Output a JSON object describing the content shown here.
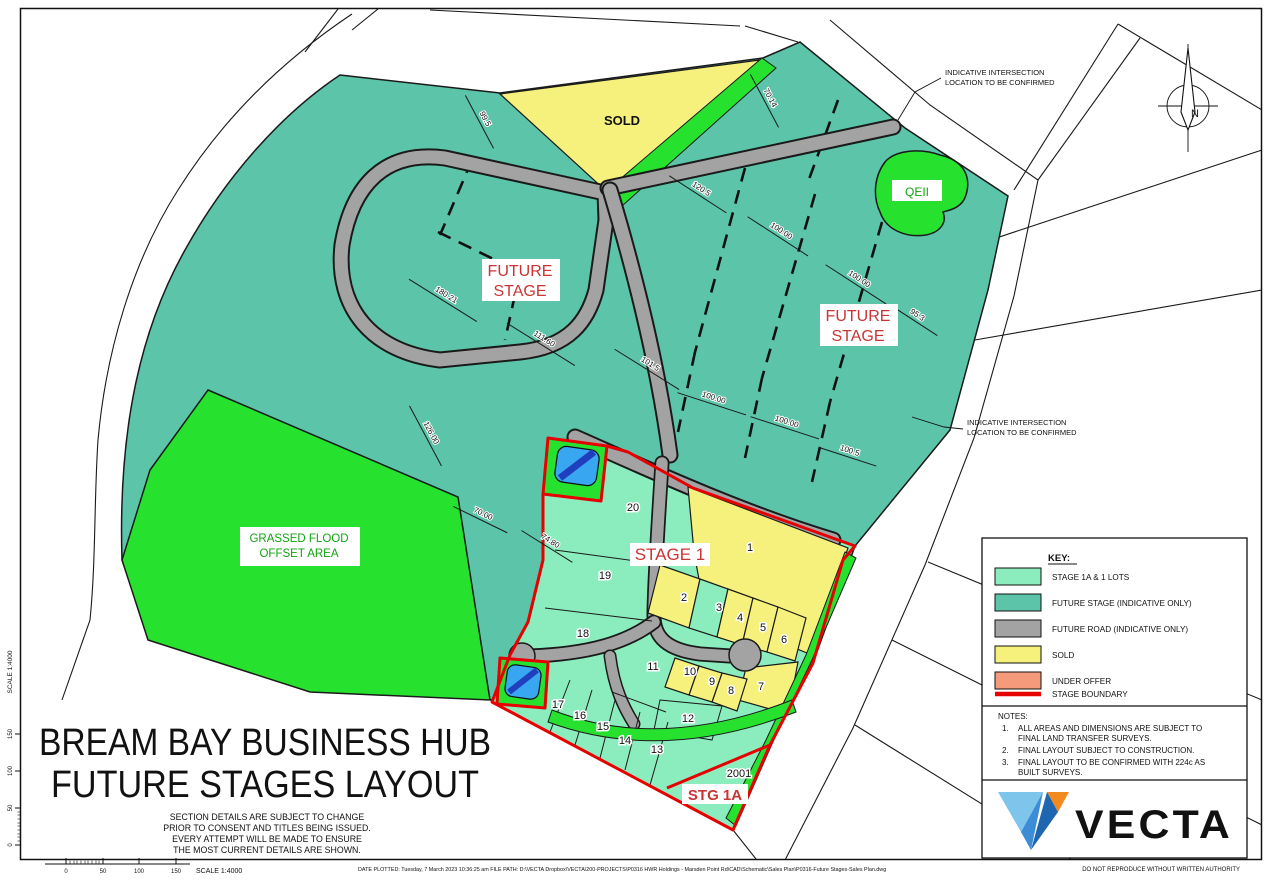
{
  "sheet": {
    "title_line1": "BREAM BAY BUSINESS HUB",
    "title_line2": "FUTURE STAGES LAYOUT",
    "disclaimer": [
      "SECTION DETAILS ARE SUBJECT TO CHANGE",
      "PRIOR TO CONSENT AND TITLES BEING ISSUED.",
      "EVERY ATTEMPT WILL BE MADE TO ENSURE",
      "THE MOST CURRENT DETAILS ARE SHOWN."
    ],
    "scale_label": "SCALE 1:4000",
    "scale_ticks": [
      "0",
      "50",
      "100",
      "150"
    ],
    "footer_plot_info": "DATE PLOTTED: Tuesday, 7 March 2023 10:36:25 am   FILE PATH: D:\\VECTA Dropbox\\VECTA\\200-PROJECTS\\P0316 HWR Holdings - Marsden Point Rd\\CAD\\Schematic\\Sales Plan\\P0316-Future Stages-Sales Plan.dwg",
    "footer_right": "DO NOT REPRODUCE WITHOUT WRITTEN AUTHORITY",
    "north_label": "N"
  },
  "key": {
    "title": "KEY:",
    "items": [
      {
        "label": "STAGE 1A & 1 LOTS",
        "color": "#8BEDBD",
        "type": "swatch"
      },
      {
        "label": "FUTURE STAGE (INDICATIVE ONLY)",
        "color": "#5BC4A9",
        "type": "swatch"
      },
      {
        "label": "FUTURE ROAD (INDICATIVE ONLY)",
        "color": "#A3A3A3",
        "type": "swatch"
      },
      {
        "label": "SOLD",
        "color": "#F6F17D",
        "type": "swatch"
      },
      {
        "label": "UNDER OFFER",
        "color": "#F59B7C",
        "type": "swatch"
      },
      {
        "label": "STAGE BOUNDARY",
        "color": "#E60000",
        "type": "line"
      }
    ]
  },
  "notes": {
    "title": "NOTES:",
    "items": [
      {
        "num": "1.",
        "lines": [
          "ALL AREAS AND DIMENSIONS ARE SUBJECT TO",
          "FINAL LAND TRANSFER SURVEYS."
        ]
      },
      {
        "num": "2.",
        "lines": [
          "FINAL LAYOUT SUBJECT TO CONSTRUCTION.",
          ""
        ]
      },
      {
        "num": "3.",
        "lines": [
          "FINAL LAYOUT TO BE CONFIRMED WITH 224c AS",
          "BUILT SURVEYS."
        ]
      }
    ]
  },
  "brand": {
    "name": "VECTA"
  },
  "map": {
    "labels": {
      "sold": "SOLD",
      "qeii": "QEII",
      "stage1": "STAGE 1",
      "stg1a": "STG 1A",
      "lot_2001": "2001",
      "future": [
        "FUTURE",
        "STAGE"
      ],
      "flood": [
        "GRASSED FLOOD",
        "OFFSET AREA"
      ],
      "indicative": [
        "INDICATIVE INTERSECTION",
        "LOCATION TO BE CONFIRMED"
      ]
    },
    "lots": [
      "1",
      "2",
      "3",
      "4",
      "5",
      "6",
      "7",
      "8",
      "9",
      "10",
      "11",
      "12",
      "13",
      "14",
      "15",
      "16",
      "17",
      "18",
      "19",
      "20"
    ],
    "dimensions": [
      "99.5",
      "180.21",
      "111.60",
      "101.5",
      "126.00",
      "70.00",
      "74.80",
      "70.14",
      "120.5",
      "100.00",
      "100.00",
      "95.3",
      "100.00",
      "100.00",
      "100.5"
    ]
  },
  "colors": {
    "stage_lots_mint": "#8BEDBD",
    "future_stage_teal": "#5BC4A9",
    "future_road_gray": "#A3A3A3",
    "sold_yellow": "#F6F17D",
    "under_offer_salmon": "#F59B7C",
    "stage_boundary_red": "#E60000",
    "reserve_green": "#27E12F",
    "pond_blue": "#38A6F0",
    "brand_navy": "#44607A",
    "brand_orange": "#F28A1F"
  }
}
